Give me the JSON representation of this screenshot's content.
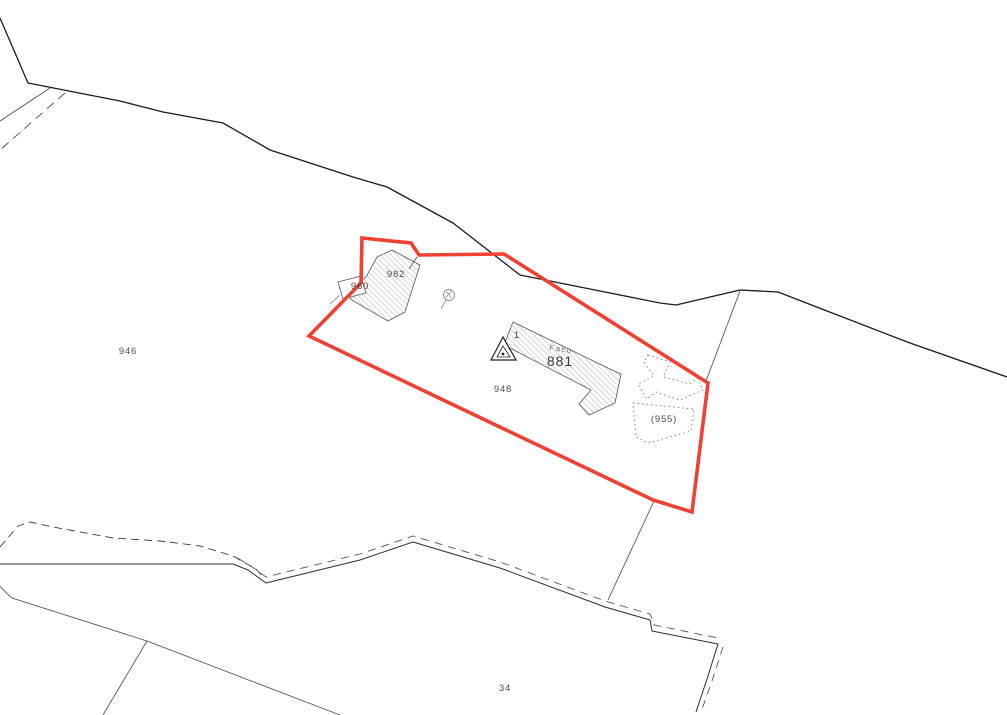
{
  "map": {
    "type": "cadastral-parcel-map",
    "labels": {
      "parcel_946": "946",
      "parcel_948": "948",
      "parcel_34": "34",
      "parcel_955": "(955)",
      "building_982": "982",
      "building_960": "960",
      "building_881": "881",
      "building_881_annotation": "Faco",
      "survey_point_1": "1"
    },
    "symbols": {
      "survey_triangle": "triangulation-point",
      "well_circle": "well-symbol"
    },
    "colors": {
      "selection": "#f04132",
      "boundary": "#1b1b1b",
      "thin_line": "#4a4a4a",
      "hatch": "#a0a0a0",
      "dotted": "#7a7a7a",
      "background": "#ffffff"
    }
  }
}
